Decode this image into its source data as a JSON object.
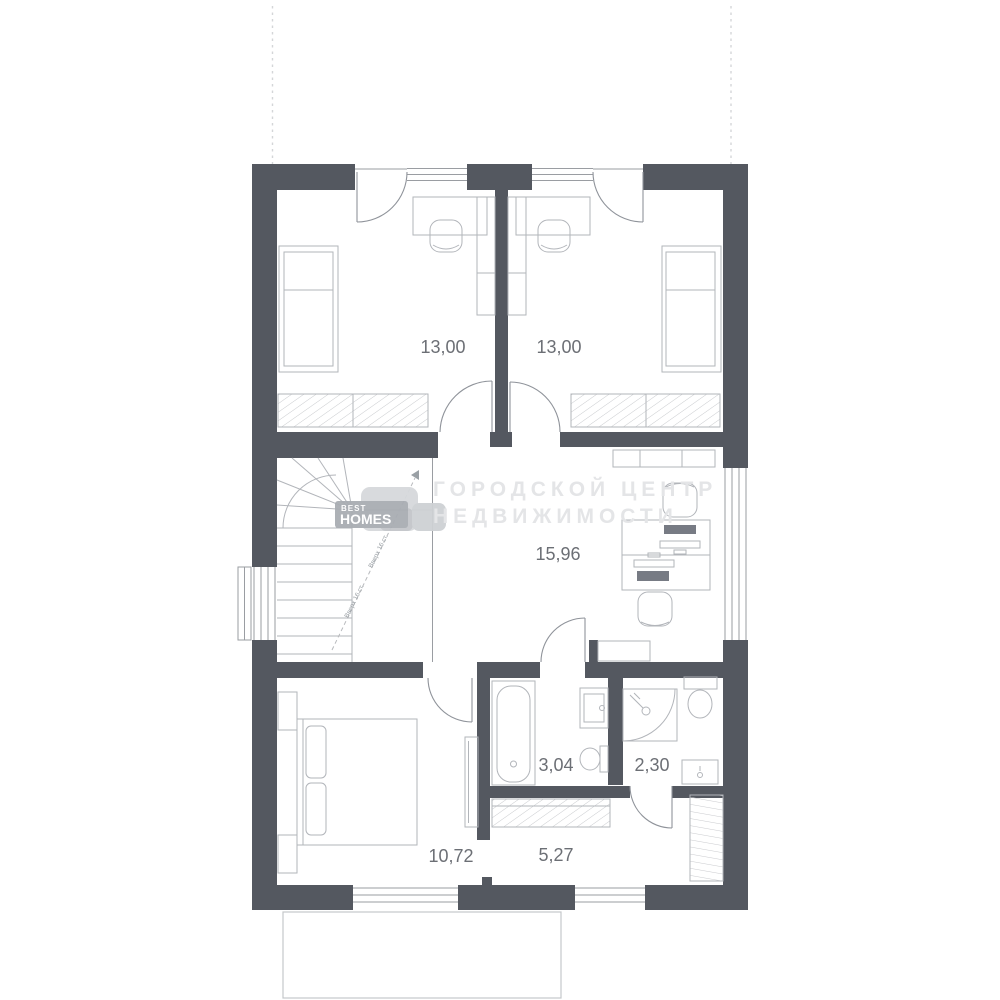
{
  "watermark": {
    "line1": "ГОРОДСКОЙ ЦЕНТР",
    "line2": "НЕДВИЖИМОСТИ"
  },
  "logo": {
    "top": "BEST",
    "bottom": "HOMES"
  },
  "rooms": [
    {
      "id": "bedroom-top-left",
      "area": "13,00"
    },
    {
      "id": "bedroom-top-right",
      "area": "13,00"
    },
    {
      "id": "hall",
      "area": "15,96"
    },
    {
      "id": "bathroom",
      "area": "3,04"
    },
    {
      "id": "wc",
      "area": "2,30"
    },
    {
      "id": "bedroom-bottom",
      "area": "10,72"
    },
    {
      "id": "corridor",
      "area": "5,27"
    }
  ],
  "stairs": {
    "annotation": "Вверх 16 ст."
  },
  "colors": {
    "wall": "#545860",
    "thin_line": "#8f939a",
    "furniture_line": "#b2b5ba",
    "hatch": "#c9cbce",
    "label_text": "#6c6f75",
    "watermark_text": "#e4e5e7",
    "logo_badge": "#a9adb3"
  }
}
